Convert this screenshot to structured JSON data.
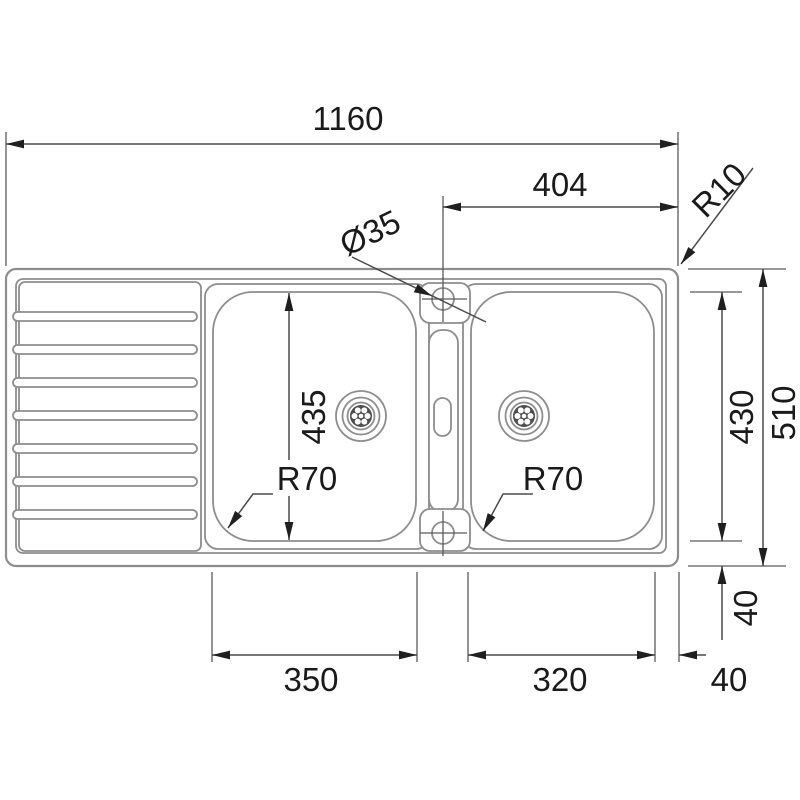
{
  "drawing": {
    "type": "technical dimension drawing, top view",
    "subject": "inset double-bowl kitchen sink with left drainboard",
    "background_color": "#ffffff",
    "outline_color": "#8d8d8d",
    "dimension_line_color": "#4a4a4a",
    "text_color": "#1a1a1a",
    "drainboard_groove_count": 7
  },
  "dimensions": {
    "overall_length": "1160",
    "tap_hole_to_right_edge": "404",
    "outer_corner_radius": "R10",
    "tap_hole_diameter": "Ø35",
    "left_bowl_length": "435",
    "left_bowl_corner_radius": "R70",
    "right_bowl_corner_radius": "R70",
    "right_bowl_length": "430",
    "overall_depth": "510",
    "left_bowl_width": "350",
    "right_bowl_width": "320",
    "right_rim_width": "40",
    "bottom_rim_width": "40"
  }
}
